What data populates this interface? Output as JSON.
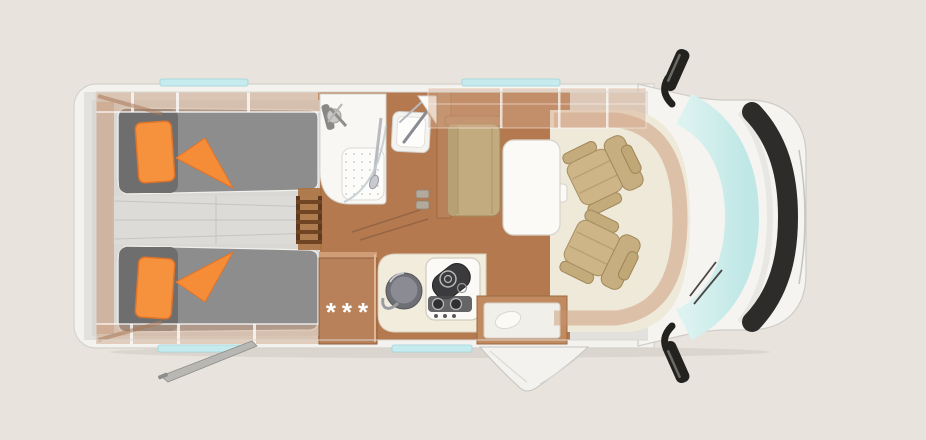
{
  "labels": {
    "fridge_rating": "***"
  },
  "colors": {
    "background": "#e8e3dc",
    "body_white": "#f4f3f0",
    "wood_floor": "#b5794f",
    "wood_cabinet": "#b9815a",
    "mattress_gray": "#8d8d8d",
    "mattress_head_gray": "#6e6e6e",
    "aisle_gray": "#dcdbd7",
    "accent_orange": "#f6913e",
    "seat_beige": "#cdb587",
    "table_white": "#fbfaf6",
    "windshield_cyan": "#cdecea",
    "window_strip_cyan": "#c6ebee",
    "trim_black": "#2d2c2a",
    "chrome": "#b9babf"
  },
  "elements": {
    "vehicle": "motorhome-top-view",
    "rear": [
      "twin-bed-top",
      "twin-bed-bottom",
      "bed-ladder",
      "center-aisle"
    ],
    "bathroom": [
      "shower-cabin",
      "shower-tray",
      "washbasin",
      "mirror-cabinet"
    ],
    "kitchen": [
      "fridge",
      "kitchen-sink",
      "stove",
      "entry-step",
      "entry-door"
    ],
    "dinette": [
      "bench-seat",
      "table"
    ],
    "cab": [
      "driver-seat",
      "passenger-seat",
      "windshield",
      "grille",
      "mirror-top",
      "mirror-bottom"
    ],
    "exterior": [
      "awning-arm",
      "window-strips"
    ]
  }
}
